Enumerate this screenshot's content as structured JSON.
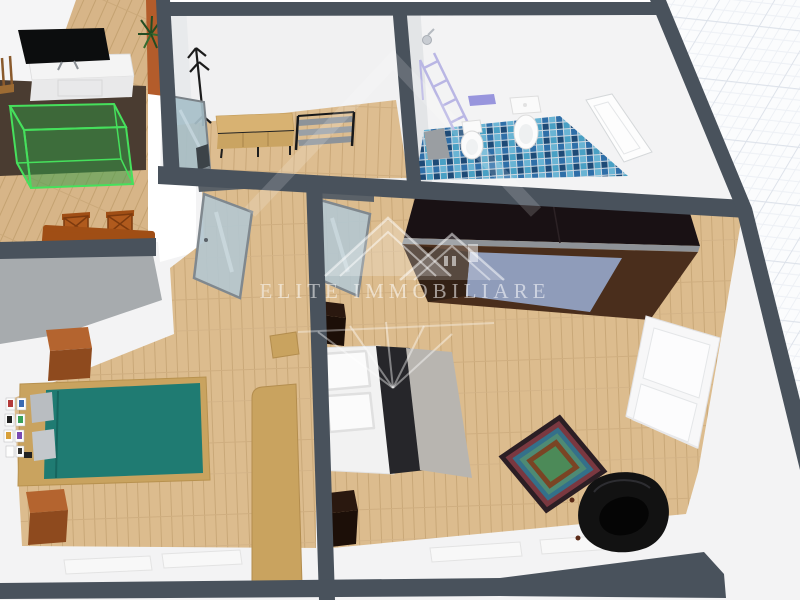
{
  "view": {
    "type": "3d-floorplan-aerial-view",
    "background": "design-grid-plane"
  },
  "watermark": {
    "text": "ELITE IMMOBILIARE",
    "logo": "house-roofs-logo",
    "color": "#ffffff"
  },
  "colors": {
    "wall_cap": "#49525c",
    "wall_face": "#f3f3f4",
    "wall_shade": "#a7abae",
    "floor_wood": "#dcbc8e",
    "accent_wall_orange": "#b35c2b",
    "selection_green": "#46e05c",
    "selection_fill": "#2f9e45",
    "living_rug_brown": "#4a3c31",
    "dining_wood": "#a04e15",
    "bed_teal": "#1f7b72",
    "bed_frame_wood": "#c9a35f",
    "nightstand_cube": "#b4642f",
    "nightstand_dark": "#2a180f",
    "wardrobe_dark": "#191114",
    "wardrobe_front_wood": "#4a2e1c",
    "wardrobe_panel_blue": "#8f9cba",
    "master_blanket_gray": "#b8b5b0",
    "master_runner_black": "#26262a",
    "armchair_black": "#121212",
    "mosaic_blue": "#2f6fa8",
    "glass_door_blue": "#a7bfc9",
    "grid_line": "#e8ecf2",
    "rug_diamond_bands": [
      "#2b1e24",
      "#7a3840",
      "#34708a",
      "#4e8a74",
      "#7a4424",
      "#4c8a58"
    ]
  },
  "rooms": {
    "living_room": {
      "name": "living room",
      "furniture": [
        "tv",
        "tv-stand",
        "plant",
        "brown-rug",
        "selection-box",
        "dining-table",
        "dining-chairs",
        "side-chair"
      ]
    },
    "hallway": {
      "name": "entry hall",
      "furniture": [
        "coat-rack",
        "glass-door",
        "console-table",
        "shoe-rack"
      ]
    },
    "bathroom": {
      "name": "bathroom",
      "furniture": [
        "shower-head",
        "shower-tray",
        "towel-ladder",
        "bidet",
        "toilet",
        "bath-mat",
        "mosaic-floor",
        "door-panel"
      ]
    },
    "bedroom_small": {
      "name": "small bedroom",
      "furniture": [
        "glass-door",
        "single-bed-teal",
        "nightstand-cube-top",
        "nightstand-cube-bottom",
        "desk",
        "wall-shelf",
        "book-shelf-items"
      ]
    },
    "bedroom_master": {
      "name": "master bedroom",
      "furniture": [
        "glass-door",
        "wardrobe",
        "double-bed",
        "nightstand-top",
        "nightstand-bottom",
        "diamond-rug",
        "egg-armchair",
        "window"
      ]
    }
  }
}
